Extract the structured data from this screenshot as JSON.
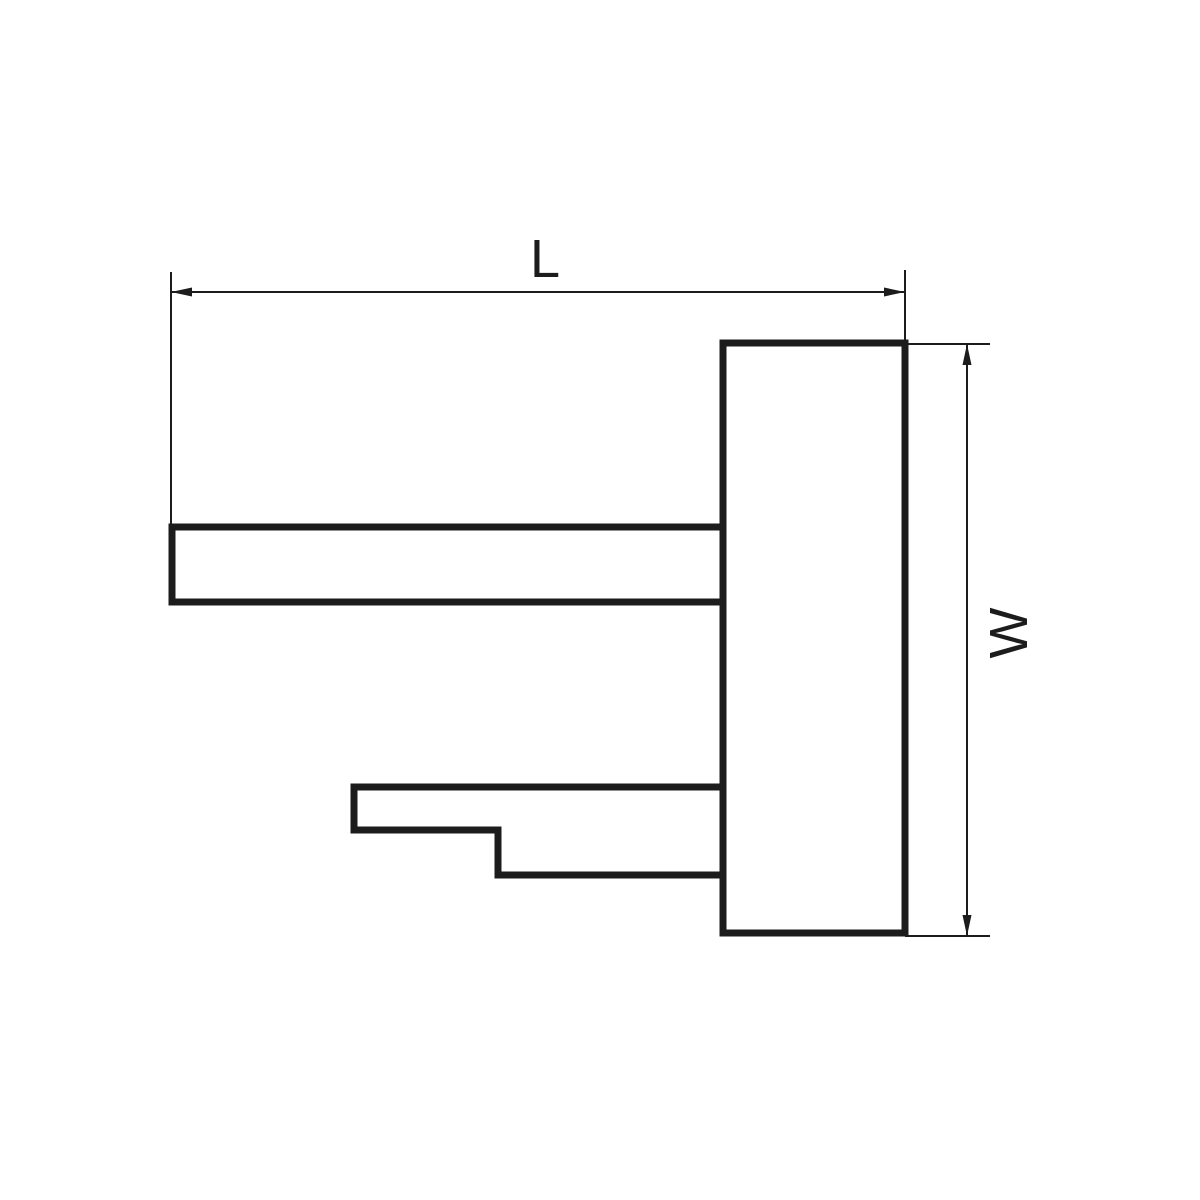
{
  "diagram": {
    "type": "technical-drawing-side-view",
    "part": {
      "name": "bracket-profile",
      "shapes": [
        "mount-plate",
        "upper-arm",
        "lower-stepped-arm"
      ]
    },
    "dimensions": [
      {
        "id": "length",
        "label": "L",
        "orientation": "horizontal"
      },
      {
        "id": "width",
        "label": "W",
        "orientation": "vertical"
      }
    ],
    "colors": {
      "line": "#1c1c1c",
      "background": "#ffffff"
    }
  }
}
